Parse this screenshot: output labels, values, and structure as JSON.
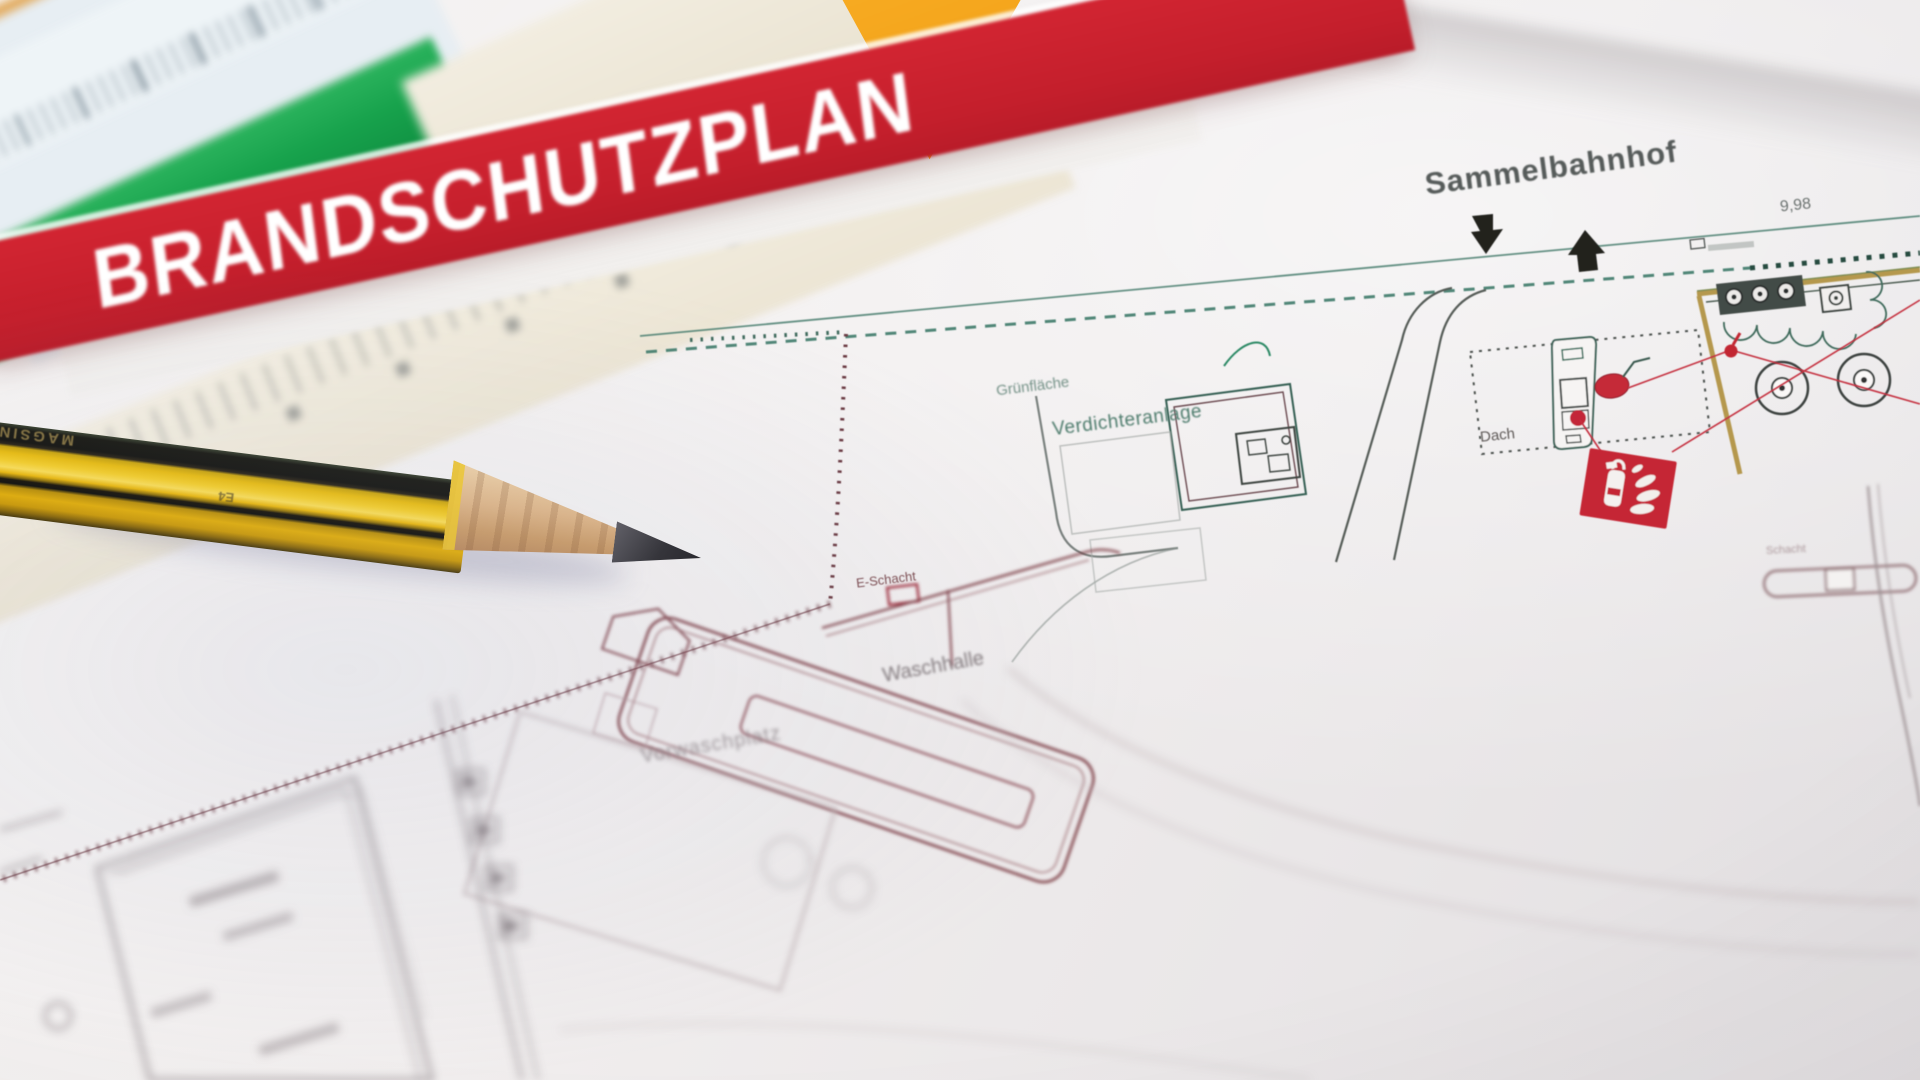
{
  "scene": {
    "type": "photograph",
    "description": "German fire protection site plan (Brandschutzplan) lying on a desk, shot at an angle with shallow depth of field; a sharpened yellow-black pencil rests on the plan and colored rulers plus an orange set square lie along the top edge."
  },
  "banner": {
    "title": "BRANDSCHUTZPLAN",
    "background_color": "#c41f2c",
    "text_color": "#ffffff"
  },
  "plan": {
    "labels": {
      "station": "Sammelbahnhof",
      "dimension": "9,98",
      "green_area": "Grünfläche",
      "compressor": "Verdichteranlage",
      "roof": "Dach",
      "e_shaft": "E-Schacht",
      "wash_hall": "Waschhalle",
      "pre_wash": "Vorwaschplatz",
      "shaft": "Schacht"
    },
    "colors": {
      "line_green": "#3f7a69",
      "line_maroon": "#7d3c45",
      "symbol_red": "#c52536",
      "wall_tan": "#b5984e"
    },
    "symbols": [
      {
        "name": "fire-extinguisher-sign",
        "color": "#c52536"
      },
      {
        "name": "alarm-point",
        "color": "#c52a39"
      },
      {
        "name": "marker-dot",
        "color": "#c32737"
      },
      {
        "name": "location-pin",
        "color": "#c22633"
      },
      {
        "name": "arrow-down",
        "color": "#20211f"
      },
      {
        "name": "arrow-up",
        "color": "#20211f"
      }
    ]
  },
  "pencil": {
    "embossed_text": "MAGSIN",
    "grade_mark": "E4",
    "body_color": "#e7bb10",
    "stripe_color": "#141410"
  },
  "rulers": {
    "green_color": "#17a24c",
    "blue_white_color": "#eef4f7",
    "cream_color": "#f3eee1",
    "set_square_orange": "#f5a11d"
  }
}
